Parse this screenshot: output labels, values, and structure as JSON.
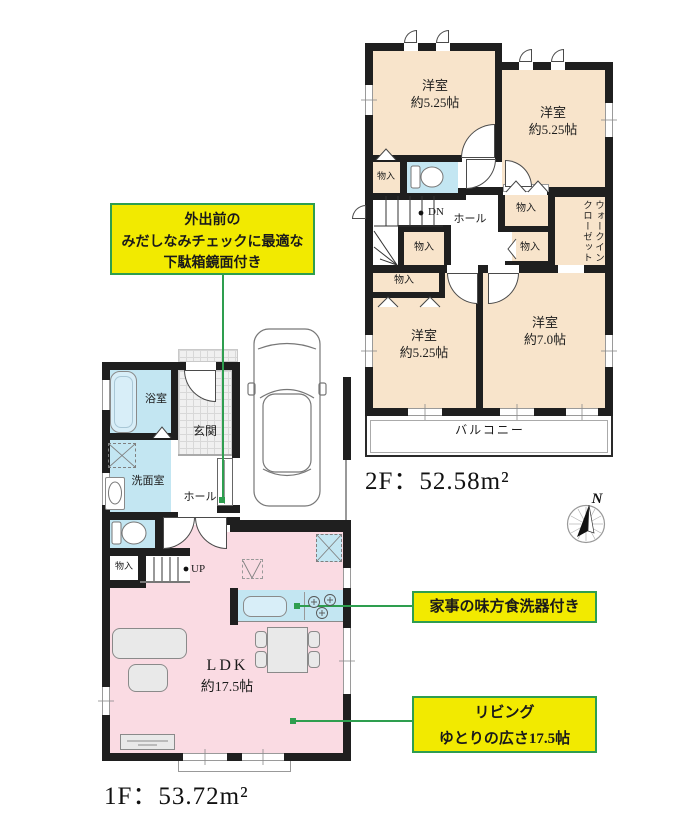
{
  "floor2": {
    "area_label": "2F：52.58m²",
    "bedroom_tl": {
      "name": "洋室",
      "size": "約5.25帖"
    },
    "bedroom_tr": {
      "name": "洋室",
      "size": "約5.25帖"
    },
    "bedroom_bl": {
      "name": "洋室",
      "size": "約5.25帖"
    },
    "bedroom_br": {
      "name": "洋室",
      "size": "約7.0帖"
    },
    "hall": "ホール",
    "walk_in_closet": "ウォークインクローゼット",
    "closet": "物入",
    "balcony": "バルコニー",
    "stairs_down": "DN"
  },
  "floor1": {
    "area_label": "1F：53.72m²",
    "bathroom": "浴室",
    "washroom": "洗面室",
    "entrance": "玄関",
    "hall": "ホール",
    "closet": "物入",
    "stairs_up": "UP",
    "ldk": {
      "name": "LDK",
      "size": "約17.5帖"
    }
  },
  "callouts": {
    "shoe_box": {
      "lines": [
        "外出前の",
        "みだしなみチェックに最適な",
        "下駄箱鏡面付き"
      ]
    },
    "dishwasher": {
      "lines": [
        "家事の味方食洗器付き"
      ]
    },
    "living": {
      "lines": [
        "リビング",
        "ゆとりの広さ17.5帖"
      ]
    }
  },
  "compass": {
    "north": "N"
  },
  "colors": {
    "wall": "#1f1f1f",
    "room_beige": "#f8e4cb",
    "ldk_pink": "#fadbe3",
    "wet_blue": "#c3e6f2",
    "highlight_yellow": "#f2ea00",
    "accent_green": "#2e9e4f"
  }
}
